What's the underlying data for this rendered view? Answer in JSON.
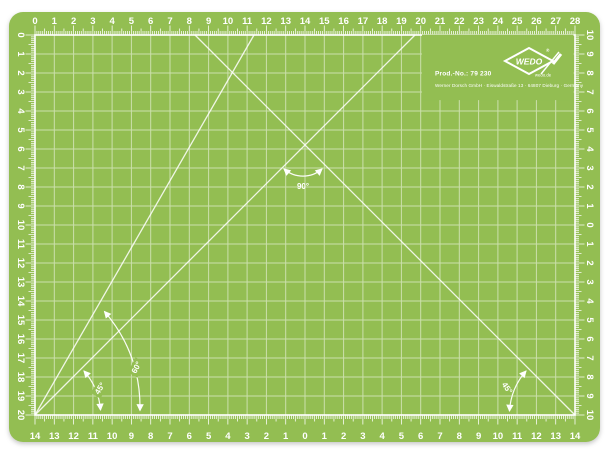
{
  "mat": {
    "colors": {
      "mat_green": "#93BE52",
      "marking_white": "#FFFFFF",
      "grid_line_tint": "#D8E7BD",
      "background": "#FFFFFF"
    },
    "rulers": {
      "unit": "cm",
      "top_cm": [
        "0",
        "1",
        "2",
        "3",
        "4",
        "5",
        "6",
        "7",
        "8",
        "9",
        "10",
        "11",
        "12",
        "13",
        "14",
        "15",
        "16",
        "17",
        "18",
        "19",
        "20",
        "21",
        "22",
        "23",
        "24",
        "25",
        "26",
        "27",
        "28"
      ],
      "bottom_cm": [
        "14",
        "13",
        "12",
        "11",
        "10",
        "9",
        "8",
        "7",
        "6",
        "5",
        "4",
        "3",
        "2",
        "1",
        "0",
        "1",
        "2",
        "3",
        "4",
        "5",
        "6",
        "7",
        "8",
        "9",
        "10",
        "11",
        "12",
        "13",
        "14"
      ],
      "left_cm": [
        "0",
        "1",
        "2",
        "3",
        "4",
        "5",
        "6",
        "7",
        "8",
        "9",
        "10",
        "11",
        "12",
        "13",
        "14",
        "15",
        "16",
        "17",
        "18",
        "19",
        "20"
      ],
      "right_cm": [
        "10",
        "9",
        "8",
        "7",
        "6",
        "5",
        "4",
        "3",
        "2",
        "1",
        "0",
        "1",
        "2",
        "3",
        "4",
        "5",
        "6",
        "7",
        "8",
        "9",
        "10"
      ]
    },
    "angles": {
      "bottom_left_45": "45°",
      "bottom_left_60": "60°",
      "apex_90": "90°",
      "bottom_right_45": "45°"
    },
    "branding": {
      "prod_no": "Prod.-No.: 79 230",
      "company_line": "Werner Dorsch GmbH · Eiswaldstraße 13 · 64807 Dieburg · Germany",
      "logo_text": "WEDO",
      "registered_mark": "®",
      "website": "wedo.de"
    }
  }
}
